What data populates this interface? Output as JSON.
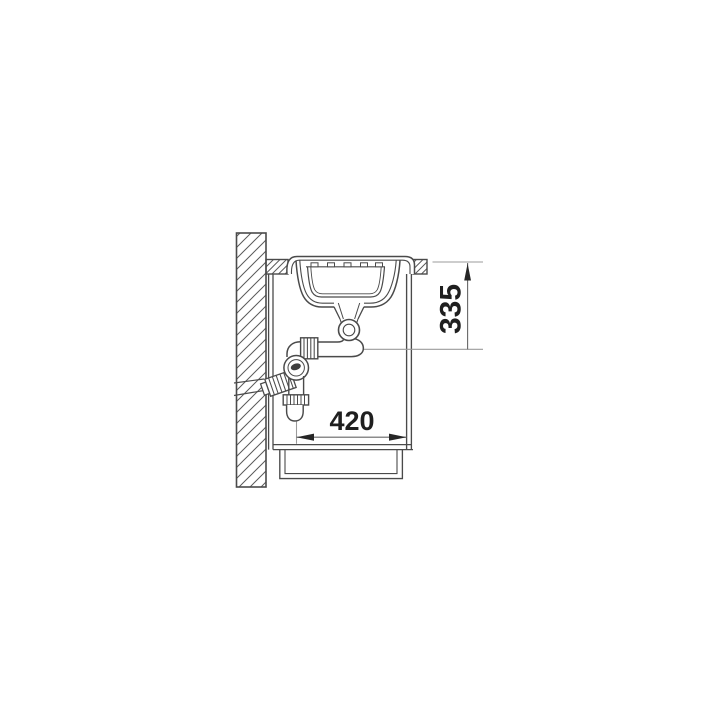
{
  "diagram": {
    "dimension_width": {
      "label": "420"
    },
    "dimension_height": {
      "label": "335"
    }
  },
  "colors": {
    "background": "#ffffff",
    "outline": "#4a4a4a",
    "hatch": "#5a5a5a",
    "extension_line": "#9b9b9b",
    "dimension_line": "#666666",
    "arrow": "#262626",
    "text": "#1f1f1f"
  }
}
